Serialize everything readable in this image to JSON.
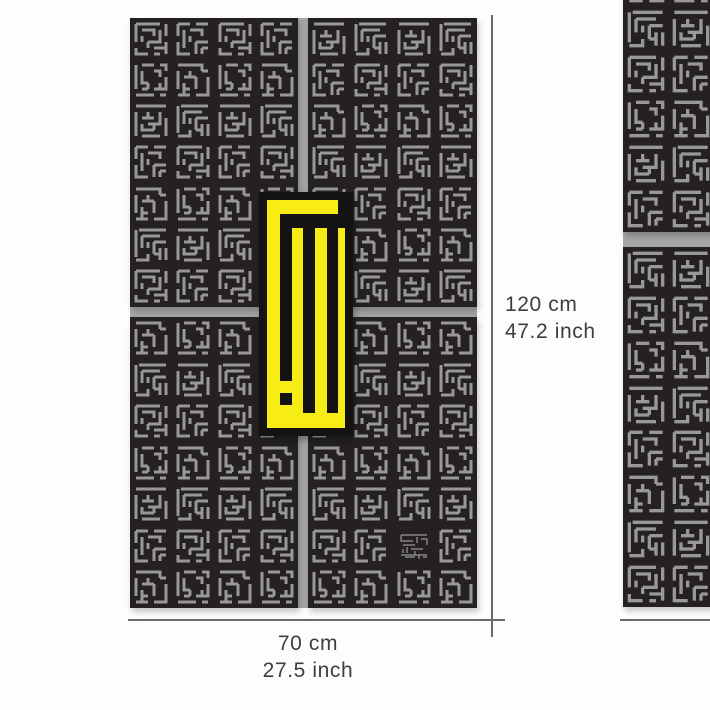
{
  "page": {
    "background": "#fdfdfd",
    "description": "square kufic calligraphy metal wall art dimensions diagram"
  },
  "annotation": {
    "line_color": "#6a6a6a",
    "text_color": "#3e3e3e",
    "height_label": {
      "cm": "120 cm",
      "inch": "47.2 inch"
    },
    "width_label": {
      "cm": "70 cm",
      "inch": "27.5 inch"
    }
  },
  "artwork": {
    "panel_color": "#252122",
    "motif_color": "#98989a",
    "gap_color": "#a6a6a6",
    "main": {
      "x": 130,
      "y": 18,
      "w": 347,
      "h": 590,
      "panels": [
        {
          "id": "top-left",
          "x": 0,
          "y": 0,
          "w": 168,
          "h": 289,
          "cols": 4,
          "rows": 7,
          "seed": 0,
          "tile": 36
        },
        {
          "id": "top-right",
          "x": 178,
          "y": 0,
          "w": 169,
          "h": 289,
          "cols": 4,
          "rows": 7,
          "seed": 2,
          "tile": 36
        },
        {
          "id": "bottom-left",
          "x": 0,
          "y": 299,
          "w": 168,
          "h": 291,
          "cols": 4,
          "rows": 7,
          "seed": 4,
          "tile": 36
        },
        {
          "id": "bottom-right",
          "x": 178,
          "y": 299,
          "w": 169,
          "h": 291,
          "cols": 4,
          "rows": 7,
          "seed": 1,
          "tile": 36
        }
      ],
      "signature_tile": {
        "panel": "bottom-right",
        "col": 2,
        "row": 5
      }
    },
    "side": {
      "x": 623,
      "y": -84,
      "w": 180,
      "h": 691,
      "panels": [
        {
          "id": "side-top",
          "x": 0,
          "y": 0,
          "w": 180,
          "h": 316,
          "cols": 4,
          "rows": 7,
          "seed": 3,
          "tile": 40
        },
        {
          "id": "side-bottom",
          "x": 0,
          "y": 331,
          "w": 180,
          "h": 360,
          "cols": 4,
          "rows": 8,
          "seed": 5,
          "tile": 40
        }
      ]
    },
    "medallion": {
      "glyph_name": "allah-square-kufic",
      "x": 259,
      "y": 192,
      "w": 94,
      "h": 244,
      "yellow": "#f7ec13",
      "black": "#151213",
      "inset": 8,
      "glyph_rects": [
        [
          79,
          8,
          7,
          28
        ],
        [
          21,
          22,
          58,
          14
        ],
        [
          21,
          36,
          12,
          153
        ],
        [
          21,
          201,
          12,
          12
        ],
        [
          44,
          36,
          12,
          185
        ],
        [
          68,
          36,
          11,
          185
        ]
      ]
    },
    "tile_paths": [
      "M3 3H27M33 3V15M3 3V21M3 27V33H15M9 9H21V15M27 9V21H15M15 21V27M21 27H33M33 21V33M9 15V21M21 33H27",
      "M3 3V27M9 3H21M27 3H33V9M9 9V21H15M21 9H27V15M33 15V27H21M15 27H9M15 27V21M3 33H21M27 33H33M27 21V27",
      "M3 3H33M3 9V33M9 15H21M27 9V21H15M9 21V27H21M33 15V27M27 33H9M33 33V27M15 15V9M21 21V27",
      "M3 3H15M21 3H33M3 3V15M3 21V33H15M9 9V27M15 9H27V15M21 21H33M21 21V33M27 27V33M33 27H27M9 33H3M15 15V21",
      "M3 3H27V9M3 9V27M9 15H21M21 15V27M9 21V33H15M33 15V33H21M3 33H9M15 27H9M27 9H33M15 15V9",
      "M6 3H33M3 3V30M9 9V21M9 9H27M21 15H33M21 15V27M27 21V33M3 33H15V27M33 21V33M15 21V15M27 27H21"
    ],
    "signature_path": "M5 7H31M5 7V13H17M21 9V15M25 11H31V17M7 17H19M11 19V25M15 21H27M19 23V27M5 27H31M7 21V25M23 27V31M9 29H19M27 29H31"
  },
  "lines": {
    "height_line": {
      "x": 491,
      "y1": 15,
      "y2": 637
    },
    "width_line": {
      "y": 619,
      "x1": 128,
      "x2": 505
    },
    "side_width_line": {
      "y": 619,
      "x1": 620,
      "x2": 712
    }
  }
}
